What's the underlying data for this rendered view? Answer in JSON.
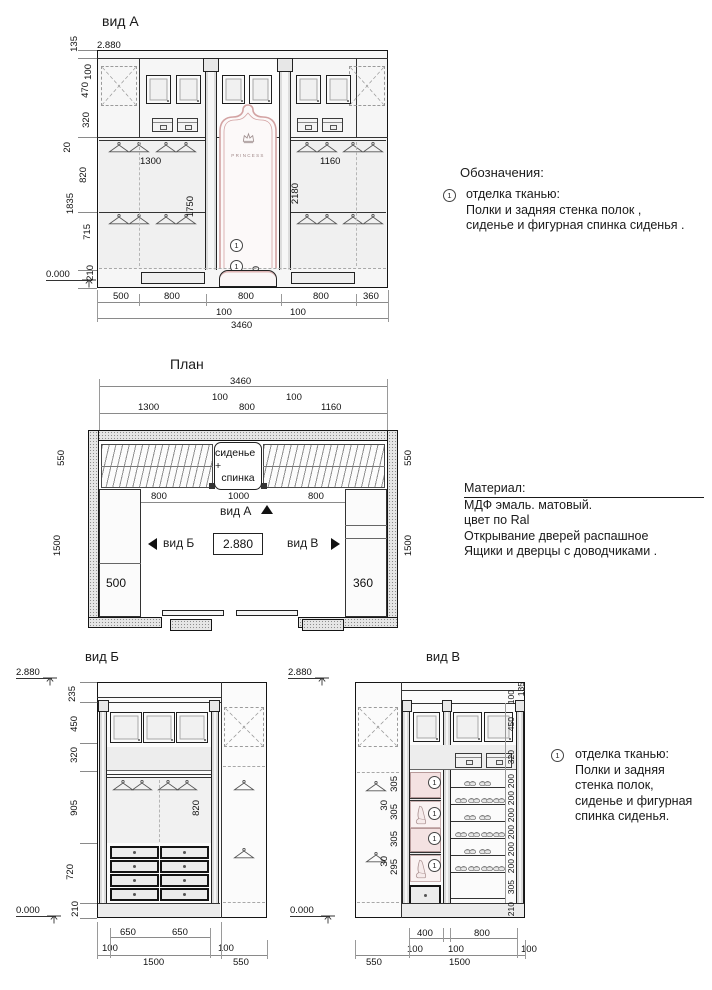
{
  "view_a": {
    "title": "вид А",
    "level_top": "2.880",
    "level_bottom": "0.000",
    "left_dims": [
      "135",
      "100",
      "470",
      "320",
      "20",
      "820",
      "1835",
      "715",
      "210"
    ],
    "width_left": "1300",
    "width_right": "1160",
    "rod_left": "1750",
    "height_right": "2180",
    "seat_height": "300",
    "brand": "PRINCESS",
    "callout": "1",
    "bottom_dims": [
      "500",
      "800",
      "800",
      "800",
      "360"
    ],
    "gap_dims": [
      "100",
      "100"
    ],
    "total_width": "3460"
  },
  "legend": {
    "heading": "Обозначения:",
    "num": "1",
    "line1": "отделка тканью:",
    "line2": "Полки и задняя стенка полок ,",
    "line3": "сиденье и фигурная спинка сиденья ."
  },
  "plan": {
    "title": "План",
    "total_width": "3460",
    "top_dims": [
      "1300",
      "100",
      "800",
      "100",
      "1160"
    ],
    "side_left": [
      "550",
      "1500"
    ],
    "side_right": [
      "550",
      "1500"
    ],
    "seat_line1": "сиденье +",
    "seat_line2": "спинка",
    "inner_dims": [
      "800",
      "1000",
      "800"
    ],
    "arrow_a": "вид А",
    "arrow_b": "вид Б",
    "arrow_v": "вид В",
    "level": "2.880",
    "cab_left": "500",
    "cab_right": "360"
  },
  "material": {
    "label": "Материал:",
    "line1_rest": " МДФ эмаль. матовый.",
    "line2": "цвет по Ral",
    "line3": "Открывание дверей распашное",
    "line4": "Ящики и дверцы с доводчиками ."
  },
  "view_b": {
    "title": "вид Б",
    "level_top": "2.880",
    "level_bottom": "0.000",
    "left_dims": [
      "235",
      "450",
      "320",
      "905",
      "720",
      "210"
    ],
    "rod_dim": "820",
    "drawer_dims": [
      "650",
      "650"
    ],
    "gap_left": "100",
    "gap_right": "100",
    "total": "1500",
    "side": "550"
  },
  "view_v": {
    "title": "вид В",
    "level_top": "2.880",
    "level_bottom": "0.000",
    "shelf_dims": [
      "305",
      "30",
      "305",
      "305",
      "30",
      "295"
    ],
    "right_dims": [
      "135",
      "100",
      "450",
      "320",
      "200",
      "200",
      "200",
      "200",
      "200",
      "200",
      "305",
      "210"
    ],
    "bottom_dims": [
      "400",
      "800"
    ],
    "gap_dims": [
      "100",
      "100",
      "100"
    ],
    "side": "550",
    "total": "1500",
    "callout": "1"
  },
  "legend2": {
    "num": "1",
    "line1": "отделка тканью:",
    "line2": "Полки и задняя",
    "line3": "стенка полок,",
    "line4": "сиденье и фигурная",
    "line5": "спинка сиденья."
  }
}
